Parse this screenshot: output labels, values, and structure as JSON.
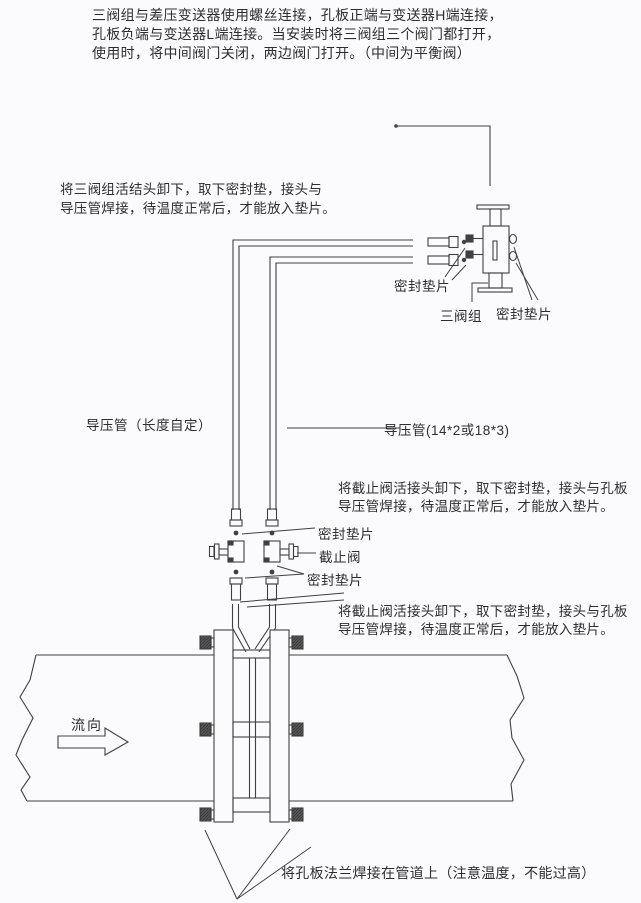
{
  "colors": {
    "background": "#fbfbfd",
    "line": "#404040",
    "text": "#2e2e2e"
  },
  "notes": {
    "intro": {
      "line1": "三阀组与差压变送器使用螺丝连接，孔板正端与变送器H端连接，",
      "line2": "孔板负端与变送器L端连接。当安装时将三阀组三个阀门都打开，",
      "line3": "使用时，将中间阀门关闭，两边阀门打开。（中间为平衡阀）"
    },
    "manifold_union": {
      "line1": "将三阀组活结头卸下，取下密封垫，接头与",
      "line2": "导压管焊接，待温度正常后，才能放入垫片。"
    },
    "stop_valve_upper": {
      "line1": "将截止阀活接头卸下，取下密封垫，接头与孔板",
      "line2": "导压管焊接，待温度正常后，才能放入垫片。"
    },
    "stop_valve_lower": {
      "line1": "将截止阀活接头卸下，取下密封垫，接头与孔板",
      "line2": "导压管焊接，待温度正常后，才能放入垫片。"
    },
    "flange_weld": "将孔板法兰焊接在管道上（注意温度，不能过高）"
  },
  "labels": {
    "seal_gasket_left": "密封垫片",
    "three_valve_manifold": "三阀组",
    "seal_gasket_right": "密封垫片",
    "impulse_pipe_custom_length": "导压管（长度自定）",
    "impulse_pipe_spec": "导压管(14*2或18*3)",
    "seal_gasket_top": "密封垫片",
    "stop_valve": "截止阀",
    "seal_gasket_bottom": "密封垫片",
    "flow_direction": "流向"
  }
}
